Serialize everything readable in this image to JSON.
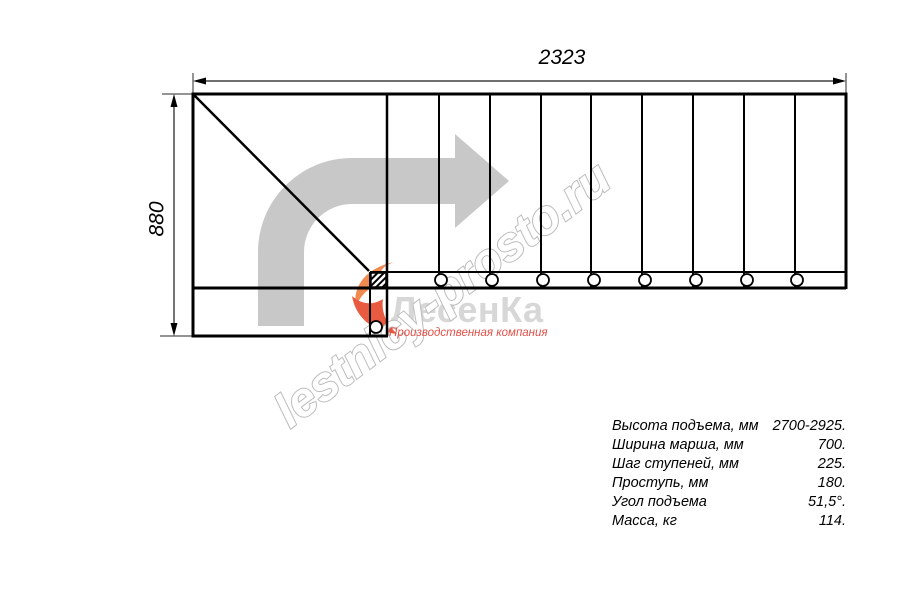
{
  "drawing": {
    "dimension_width_label": "2323",
    "dimension_height_label": "880"
  },
  "watermark": {
    "site_text": "lestnicy-prosto.ru",
    "logo_text": "ЛесенКа",
    "tagline": "Производственная компания"
  },
  "specs": {
    "rows": [
      {
        "label": "Высота подъема, мм",
        "value": "2700-2925."
      },
      {
        "label": "Ширина марша, мм",
        "value": "700."
      },
      {
        "label": "Шаг ступеней, мм",
        "value": "225."
      },
      {
        "label": "Проступь, мм",
        "value": "180."
      },
      {
        "label": "Угол подъема",
        "value": "51,5°."
      },
      {
        "label": "Масса, кг",
        "value": "114."
      }
    ]
  },
  "colors": {
    "line": "#000000",
    "direction_arrow_gray": "#c8c8c8",
    "watermark_stroke_gray": "#bcbcbc",
    "logo_text_gray": "#d7d7d7",
    "logo_flame_orange": "#ef7b46",
    "tagline_red": "#e25048"
  }
}
